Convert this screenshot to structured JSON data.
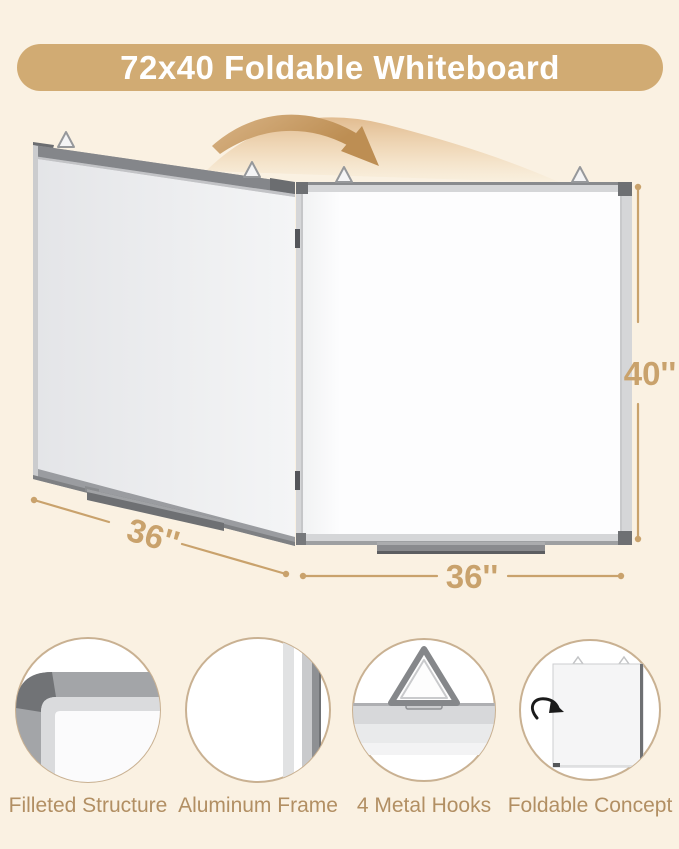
{
  "banner": {
    "title": "72x40 Foldable Whiteboard"
  },
  "dimensions": {
    "height": "40''",
    "left_panel_width": "36''",
    "right_panel_width": "36''"
  },
  "features": [
    {
      "icon": "rounded-corner-icon",
      "label": "Filleted Structure"
    },
    {
      "icon": "aluminum-frame-profile-icon",
      "label": "Aluminum Frame"
    },
    {
      "icon": "triangle-hook-icon",
      "label": "4 Metal Hooks"
    },
    {
      "icon": "folding-board-icon",
      "label": "Foldable Concept"
    }
  ],
  "colors": {
    "background": "#FAF1E2",
    "banner_bg": "#D1AB73",
    "banner_text": "#FFFFFF",
    "dimension_accent": "#C9A26C",
    "feature_label": "#B28F63",
    "feature_circle_border": "#C9B192",
    "frame_gray": "#9A9CA0",
    "board_white": "#FDFDFE"
  }
}
